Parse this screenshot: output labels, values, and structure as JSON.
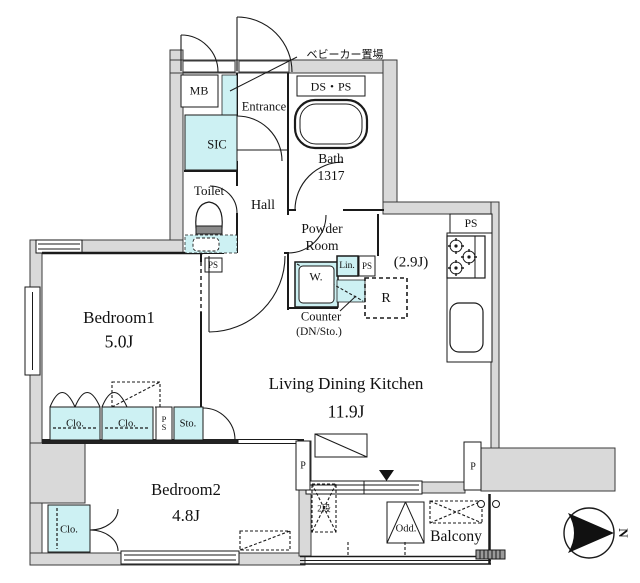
{
  "rooms": {
    "entrance": "Entrance",
    "hall": "Hall",
    "sic": "SIC",
    "toilet": "Toilet",
    "bath_name": "Bath",
    "bath_size": "1317",
    "powder_line1": "Powder",
    "powder_line2": "Room",
    "kitchen_size": "(2.9J)",
    "ldk_name": "Living Dining Kitchen",
    "ldk_size": "11.9J",
    "bedroom1_name": "Bedroom1",
    "bedroom1_size": "5.0J",
    "bedroom2_name": "Bedroom2",
    "bedroom2_size": "4.8J",
    "balcony": "Balcony"
  },
  "fixtures": {
    "stroller_area": "ベビーカー置場",
    "mb": "MB",
    "ds_ps": "DS・PS",
    "ps": "PS",
    "lin": "Lin.",
    "washer": "W.",
    "fridge": "R",
    "counter_line1": "Counter",
    "counter_line2": "(DN/Sto.)",
    "closet": "Clo.",
    "storage": "Sto.",
    "pillar": "P",
    "outdoor_unit": "Odd.",
    "two_step": "2段",
    "north": "N"
  },
  "colors": {
    "fixture_cyan": "#cdf1f3",
    "wall_gray": "#d9d9d9",
    "line": "#1a1a1a"
  }
}
